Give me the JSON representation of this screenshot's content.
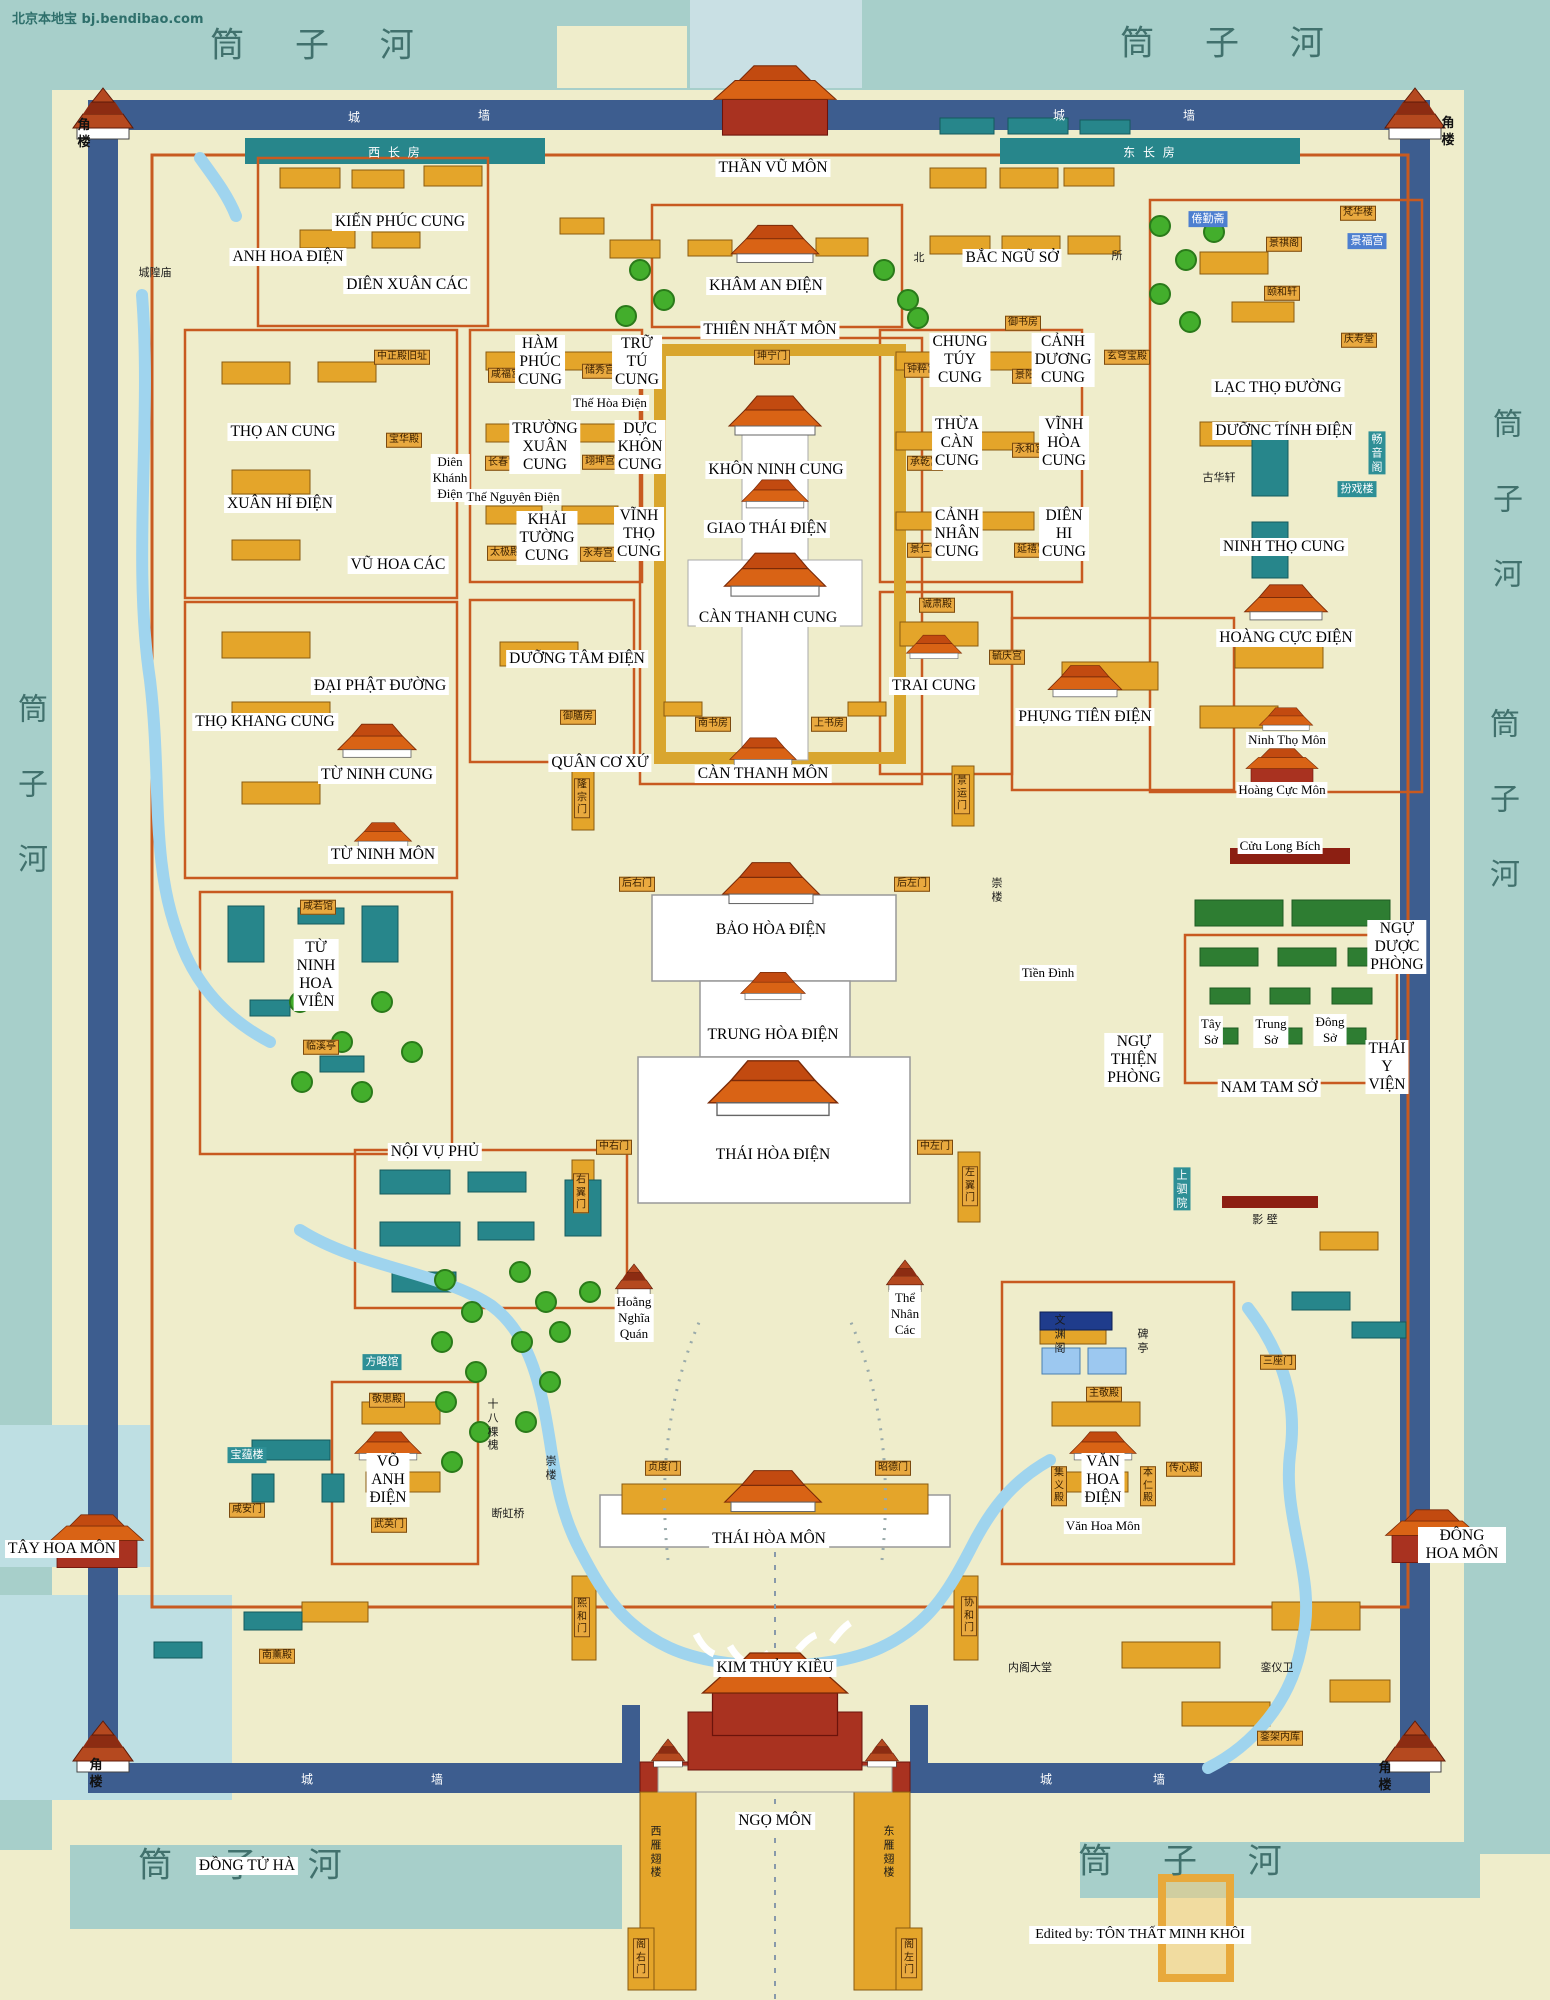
{
  "map": {
    "watermark": "北京本地宝  bj.bendibao.com",
    "credit": "Edited by: TÔN THẤT MINH KHÔI"
  },
  "colors": {
    "moat": "#A7CFCA",
    "ground": "#EFEDCB",
    "wall": "#3D5D8F",
    "building_orange": "#E4A52A",
    "building_teal": "#27868B",
    "garden_green": "#2E7D32",
    "water": "#9FD4EE",
    "roof_orange": "#D96315",
    "roof_red": "#A93220",
    "courtyard_outline": "#C85A20",
    "river_text": "#41716D",
    "label_blue": "#4D7FD0",
    "label_teal": "#2E8F96",
    "plate": "#E9A93F"
  },
  "labels": [
    {
      "t": "筒 子 河",
      "x": 322,
      "y": 42,
      "c": "rv"
    },
    {
      "t": "筒 子 河",
      "x": 1232,
      "y": 40,
      "c": "rv"
    },
    {
      "t": "筒 子 河",
      "x": 1190,
      "y": 1858,
      "c": "rv"
    },
    {
      "t": "筒 子 河",
      "x": 250,
      "y": 1862,
      "c": "rv"
    },
    {
      "t": "筒\n子\n河",
      "x": 33,
      "y": 785,
      "c": "rvv"
    },
    {
      "t": "筒\n子\n河",
      "x": 1508,
      "y": 500,
      "c": "rvv"
    },
    {
      "t": "筒\n子\n河",
      "x": 1505,
      "y": 800,
      "c": "rvv"
    },
    {
      "t": "角\n楼",
      "x": 84,
      "y": 135,
      "c": "ck"
    },
    {
      "t": "角\n楼",
      "x": 1448,
      "y": 133,
      "c": "ck"
    },
    {
      "t": "角\n楼",
      "x": 96,
      "y": 1775,
      "c": "ck"
    },
    {
      "t": "角\n楼",
      "x": 1385,
      "y": 1778,
      "c": "ck"
    },
    {
      "t": "城",
      "x": 355,
      "y": 117,
      "c": "wl"
    },
    {
      "t": "墙",
      "x": 485,
      "y": 115,
      "c": "wl"
    },
    {
      "t": "城",
      "x": 1060,
      "y": 115,
      "c": "wl"
    },
    {
      "t": "墙",
      "x": 1190,
      "y": 115,
      "c": "wl"
    },
    {
      "t": "城",
      "x": 308,
      "y": 1779,
      "c": "wl"
    },
    {
      "t": "墙",
      "x": 438,
      "y": 1779,
      "c": "wl"
    },
    {
      "t": "城",
      "x": 1047,
      "y": 1779,
      "c": "wl"
    },
    {
      "t": "墙",
      "x": 1160,
      "y": 1779,
      "c": "wl"
    },
    {
      "t": "西 长 房",
      "x": 395,
      "y": 152,
      "c": "wl"
    },
    {
      "t": "东 长 房",
      "x": 1150,
      "y": 152,
      "c": "wl"
    },
    {
      "t": "THẦN VŨ MÔN",
      "x": 773,
      "y": 168,
      "c": "vn"
    },
    {
      "t": "KIẾN PHÚC CUNG",
      "x": 400,
      "y": 222,
      "c": "vn"
    },
    {
      "t": "ANH HOA ĐIỆN",
      "x": 288,
      "y": 257,
      "c": "vn"
    },
    {
      "t": "DIÊN XUÂN CÁC",
      "x": 407,
      "y": 285,
      "c": "vn"
    },
    {
      "t": "KHÂM AN ĐIỆN",
      "x": 766,
      "y": 286,
      "c": "vn"
    },
    {
      "t": "BẮC NGŨ SỞ",
      "x": 1012,
      "y": 258,
      "c": "vn"
    },
    {
      "t": "THIÊN NHẤT MÔN",
      "x": 770,
      "y": 330,
      "c": "vn"
    },
    {
      "t": "TRỮ\nTÚ\nCUNG",
      "x": 637,
      "y": 362,
      "c": "vn"
    },
    {
      "t": "HÀM\nPHÚC\nCUNG",
      "x": 540,
      "y": 362,
      "c": "vn"
    },
    {
      "t": "CHUNG\nTÚY\nCUNG",
      "x": 960,
      "y": 360,
      "c": "vn"
    },
    {
      "t": "CẢNH\nDƯƠNG\nCUNG",
      "x": 1063,
      "y": 360,
      "c": "vn"
    },
    {
      "t": "THỌ AN CUNG",
      "x": 283,
      "y": 432,
      "c": "vn"
    },
    {
      "t": "XUÂN HỈ ĐIỆN",
      "x": 280,
      "y": 504,
      "c": "vn"
    },
    {
      "t": "TRƯỜNG\nXUÂN\nCUNG",
      "x": 545,
      "y": 447,
      "c": "vn"
    },
    {
      "t": "DỰC\nKHÔN\nCUNG",
      "x": 640,
      "y": 447,
      "c": "vn"
    },
    {
      "t": "KHÔN NINH CUNG",
      "x": 776,
      "y": 470,
      "c": "vn"
    },
    {
      "t": "THỪA\nCÀN\nCUNG",
      "x": 957,
      "y": 443,
      "c": "vn"
    },
    {
      "t": "VĨNH\nHÒA\nCUNG",
      "x": 1064,
      "y": 443,
      "c": "vn"
    },
    {
      "t": "LẠC THỌ ĐƯỜNG",
      "x": 1278,
      "y": 388,
      "c": "vn"
    },
    {
      "t": "DƯỠNC TÍNH ĐIỆN",
      "x": 1284,
      "y": 431,
      "c": "vn"
    },
    {
      "t": "KHẢI\nTƯỜNG\nCUNG",
      "x": 547,
      "y": 538,
      "c": "vn"
    },
    {
      "t": "VĨNH\nTHỌ\nCUNG",
      "x": 639,
      "y": 534,
      "c": "vn"
    },
    {
      "t": "GIAO THÁI ĐIỆN",
      "x": 767,
      "y": 529,
      "c": "vn"
    },
    {
      "t": "CẢNH\nNHÂN\nCUNG",
      "x": 957,
      "y": 534,
      "c": "vn"
    },
    {
      "t": "DIÊN\nHI\nCUNG",
      "x": 1064,
      "y": 534,
      "c": "vn"
    },
    {
      "t": "NINH THỌ CUNG",
      "x": 1284,
      "y": 547,
      "c": "vn"
    },
    {
      "t": "VŨ HOA CÁC",
      "x": 398,
      "y": 565,
      "c": "vn"
    },
    {
      "t": "CÀN THANH CUNG",
      "x": 768,
      "y": 618,
      "c": "vn"
    },
    {
      "t": "DƯỠNG TÂM ĐIỆN",
      "x": 577,
      "y": 659,
      "c": "vn"
    },
    {
      "t": "TRAI CUNG",
      "x": 934,
      "y": 686,
      "c": "vn"
    },
    {
      "t": "HOÀNG CỰC ĐIỆN",
      "x": 1286,
      "y": 638,
      "c": "vn"
    },
    {
      "t": "PHỤNG TIÊN ĐIỆN",
      "x": 1085,
      "y": 717,
      "c": "vn"
    },
    {
      "t": "ĐẠI PHẬT ĐƯỜNG",
      "x": 380,
      "y": 686,
      "c": "vn"
    },
    {
      "t": "THỌ KHANG CUNG",
      "x": 265,
      "y": 722,
      "c": "vn"
    },
    {
      "t": "QUÂN CƠ XỨ",
      "x": 600,
      "y": 763,
      "c": "vn"
    },
    {
      "t": "CÀN THANH MÔN",
      "x": 763,
      "y": 774,
      "c": "vn"
    },
    {
      "t": "TỪ NINH CUNG",
      "x": 377,
      "y": 775,
      "c": "vn"
    },
    {
      "t": "TỪ NINH MÔN",
      "x": 383,
      "y": 855,
      "c": "vn"
    },
    {
      "t": "BẢO HÒA ĐIỆN",
      "x": 771,
      "y": 930,
      "c": "vn"
    },
    {
      "t": "TỪ\nNINH\nHOA\nVIÊN",
      "x": 316,
      "y": 975,
      "c": "vn"
    },
    {
      "t": "NGỰ\nDƯỢC\nPHÒNG",
      "x": 1397,
      "y": 947,
      "c": "vn"
    },
    {
      "t": "TRUNG HÒA ĐIỆN",
      "x": 773,
      "y": 1035,
      "c": "vn"
    },
    {
      "t": "NGỰ\nTHIỆN\nPHÒNG",
      "x": 1134,
      "y": 1060,
      "c": "vn"
    },
    {
      "t": "THÁI\nY\nVIỆN",
      "x": 1387,
      "y": 1067,
      "c": "vn"
    },
    {
      "t": "NAM TAM SỞ",
      "x": 1269,
      "y": 1088,
      "c": "vn"
    },
    {
      "t": "NỘI VỤ PHỦ",
      "x": 435,
      "y": 1152,
      "c": "vn"
    },
    {
      "t": "THÁI HÒA ĐIỆN",
      "x": 773,
      "y": 1155,
      "c": "vn"
    },
    {
      "t": "VÕ\nANH\nĐIỆN",
      "x": 388,
      "y": 1480,
      "c": "vn"
    },
    {
      "t": "VĂN\nHOA\nĐIỆN",
      "x": 1103,
      "y": 1480,
      "c": "vn"
    },
    {
      "t": "THÁI HÒA MÔN",
      "x": 769,
      "y": 1539,
      "c": "vn"
    },
    {
      "t": "TÂY HOA MÔN",
      "x": 62,
      "y": 1549,
      "c": "vn"
    },
    {
      "t": "ĐÔNG HOA MÔN",
      "x": 1462,
      "y": 1545,
      "c": "vn"
    },
    {
      "t": "KIM THỦY KIỀU",
      "x": 775,
      "y": 1668,
      "c": "vn"
    },
    {
      "t": "NGỌ MÔN",
      "x": 775,
      "y": 1821,
      "c": "vn"
    },
    {
      "t": "ĐỒNG TỬ HÀ",
      "x": 247,
      "y": 1866,
      "c": "vn"
    },
    {
      "t": "Ninh Thọ Môn",
      "x": 1287,
      "y": 740,
      "c": "vs"
    },
    {
      "t": "Hoàng Cực Môn",
      "x": 1282,
      "y": 790,
      "c": "vs"
    },
    {
      "t": "Cửu Long Bích",
      "x": 1280,
      "y": 846,
      "c": "vs"
    },
    {
      "t": "Tiền Đình",
      "x": 1048,
      "y": 973,
      "c": "vs"
    },
    {
      "t": "Tây\nSở",
      "x": 1211,
      "y": 1032,
      "c": "vs"
    },
    {
      "t": "Trung\nSở",
      "x": 1271,
      "y": 1032,
      "c": "vs"
    },
    {
      "t": "Đông\nSở",
      "x": 1330,
      "y": 1030,
      "c": "vs"
    },
    {
      "t": "Hoằng\nNghĩa\nQuán",
      "x": 634,
      "y": 1318,
      "c": "vs"
    },
    {
      "t": "Thể\nNhân\nCác",
      "x": 905,
      "y": 1314,
      "c": "vs"
    },
    {
      "t": "Văn Hoa Môn",
      "x": 1103,
      "y": 1526,
      "c": "vs"
    },
    {
      "t": "Diên\nKhánh\nĐiện",
      "x": 450,
      "y": 478,
      "c": "vs"
    },
    {
      "t": "Thế Nguyên Điện",
      "x": 513,
      "y": 497,
      "c": "vs"
    },
    {
      "t": "Thế Hòa Điện",
      "x": 610,
      "y": 403,
      "c": "vs"
    },
    {
      "t": "中正殿旧址",
      "x": 402,
      "y": 357,
      "c": "cp"
    },
    {
      "t": "宝华殿",
      "x": 404,
      "y": 440,
      "c": "cp"
    },
    {
      "t": "坤宁门",
      "x": 772,
      "y": 357,
      "c": "cp"
    },
    {
      "t": "咸福宫",
      "x": 506,
      "y": 375,
      "c": "cp"
    },
    {
      "t": "储秀宫",
      "x": 600,
      "y": 371,
      "c": "cp"
    },
    {
      "t": "长春宫",
      "x": 503,
      "y": 463,
      "c": "cp"
    },
    {
      "t": "翊坤宫",
      "x": 600,
      "y": 462,
      "c": "cp"
    },
    {
      "t": "太极殿",
      "x": 505,
      "y": 553,
      "c": "cp"
    },
    {
      "t": "永寿宫",
      "x": 598,
      "y": 554,
      "c": "cp"
    },
    {
      "t": "钟粹宫",
      "x": 922,
      "y": 370,
      "c": "cp"
    },
    {
      "t": "景阳宫",
      "x": 1030,
      "y": 376,
      "c": "cp"
    },
    {
      "t": "承乾宫",
      "x": 925,
      "y": 463,
      "c": "cp"
    },
    {
      "t": "永和宫",
      "x": 1030,
      "y": 450,
      "c": "cp"
    },
    {
      "t": "景仁宫",
      "x": 925,
      "y": 550,
      "c": "cp"
    },
    {
      "t": "延禧宫",
      "x": 1032,
      "y": 550,
      "c": "cp"
    },
    {
      "t": "御书房",
      "x": 1023,
      "y": 323,
      "c": "cp"
    },
    {
      "t": "玄穹宝殿",
      "x": 1127,
      "y": 357,
      "c": "cp"
    },
    {
      "t": "景祺阁",
      "x": 1284,
      "y": 244,
      "c": "cp"
    },
    {
      "t": "颐和轩",
      "x": 1282,
      "y": 293,
      "c": "cp"
    },
    {
      "t": "梵华楼",
      "x": 1358,
      "y": 213,
      "c": "cp"
    },
    {
      "t": "庆寿堂",
      "x": 1359,
      "y": 340,
      "c": "cp"
    },
    {
      "t": "诚肃殿",
      "x": 937,
      "y": 605,
      "c": "cp"
    },
    {
      "t": "毓庆宫",
      "x": 1007,
      "y": 657,
      "c": "cp"
    },
    {
      "t": "南书房",
      "x": 713,
      "y": 724,
      "c": "cp"
    },
    {
      "t": "上书房",
      "x": 829,
      "y": 724,
      "c": "cp"
    },
    {
      "t": "御膳房",
      "x": 578,
      "y": 717,
      "c": "cp"
    },
    {
      "t": "隆\n宗\n门",
      "x": 582,
      "y": 798,
      "c": "cp"
    },
    {
      "t": "景\n运\n门",
      "x": 962,
      "y": 794,
      "c": "cp"
    },
    {
      "t": "后右门",
      "x": 637,
      "y": 884,
      "c": "cp"
    },
    {
      "t": "后左门",
      "x": 912,
      "y": 884,
      "c": "cp"
    },
    {
      "t": "中右门",
      "x": 614,
      "y": 1147,
      "c": "cp"
    },
    {
      "t": "中左门",
      "x": 935,
      "y": 1147,
      "c": "cp"
    },
    {
      "t": "右\n翼\n门",
      "x": 581,
      "y": 1193,
      "c": "cp"
    },
    {
      "t": "左\n翼\n门",
      "x": 970,
      "y": 1186,
      "c": "cp"
    },
    {
      "t": "贞度门",
      "x": 663,
      "y": 1468,
      "c": "cp"
    },
    {
      "t": "昭德门",
      "x": 893,
      "y": 1468,
      "c": "cp"
    },
    {
      "t": "武英门",
      "x": 389,
      "y": 1525,
      "c": "cp"
    },
    {
      "t": "咸安门",
      "x": 247,
      "y": 1510,
      "c": "cp"
    },
    {
      "t": "敬思殿",
      "x": 387,
      "y": 1400,
      "c": "cp"
    },
    {
      "t": "主敬殿",
      "x": 1104,
      "y": 1394,
      "c": "cp"
    },
    {
      "t": "三座门",
      "x": 1278,
      "y": 1362,
      "c": "cp"
    },
    {
      "t": "熙\n和\n门",
      "x": 582,
      "y": 1617,
      "c": "cp"
    },
    {
      "t": "协\n和\n门",
      "x": 969,
      "y": 1616,
      "c": "cp"
    },
    {
      "t": "阁\n右\n门",
      "x": 641,
      "y": 1958,
      "c": "cp"
    },
    {
      "t": "阁\n左\n门",
      "x": 909,
      "y": 1958,
      "c": "cp"
    },
    {
      "t": "咸若馆",
      "x": 318,
      "y": 907,
      "c": "cp"
    },
    {
      "t": "临溪亭",
      "x": 321,
      "y": 1047,
      "c": "cp"
    },
    {
      "t": "南薰殿",
      "x": 277,
      "y": 1656,
      "c": "cp"
    },
    {
      "t": "銮架内库",
      "x": 1280,
      "y": 1738,
      "c": "cp"
    },
    {
      "t": "传心殿",
      "x": 1184,
      "y": 1469,
      "c": "cp"
    },
    {
      "t": "本\n仁\n殿",
      "x": 1148,
      "y": 1486,
      "c": "cp"
    },
    {
      "t": "集\n义\n殿",
      "x": 1059,
      "y": 1486,
      "c": "cp"
    },
    {
      "t": "城隍庙",
      "x": 155,
      "y": 273,
      "c": "cs"
    },
    {
      "t": "北",
      "x": 919,
      "y": 258,
      "c": "cs"
    },
    {
      "t": "所",
      "x": 1117,
      "y": 256,
      "c": "cs"
    },
    {
      "t": "古华轩",
      "x": 1219,
      "y": 478,
      "c": "cs"
    },
    {
      "t": "断虹桥",
      "x": 508,
      "y": 1514,
      "c": "cs"
    },
    {
      "t": "十\n八\n棵\n槐",
      "x": 493,
      "y": 1425,
      "c": "cs"
    },
    {
      "t": "崇\n楼",
      "x": 997,
      "y": 890,
      "c": "cs"
    },
    {
      "t": "崇\n楼",
      "x": 551,
      "y": 1468,
      "c": "cs"
    },
    {
      "t": "内阁大堂",
      "x": 1030,
      "y": 1668,
      "c": "cs"
    },
    {
      "t": "銮仪卫",
      "x": 1277,
      "y": 1668,
      "c": "cs"
    },
    {
      "t": "影 壁",
      "x": 1265,
      "y": 1220,
      "c": "cs"
    },
    {
      "t": "文\n渊\n阁",
      "x": 1060,
      "y": 1334,
      "c": "cs"
    },
    {
      "t": "碑\n亭",
      "x": 1143,
      "y": 1341,
      "c": "cs"
    },
    {
      "t": "西\n雁\n翅\n楼",
      "x": 656,
      "y": 1852,
      "c": "cs"
    },
    {
      "t": "东\n雁\n翅\n楼",
      "x": 889,
      "y": 1852,
      "c": "cs"
    },
    {
      "t": "倦勤斋",
      "x": 1208,
      "y": 219,
      "c": "cb"
    },
    {
      "t": "景福宫",
      "x": 1367,
      "y": 241,
      "c": "cb"
    },
    {
      "t": "方略馆",
      "x": 382,
      "y": 1362,
      "c": "ct"
    },
    {
      "t": "宝蕴楼",
      "x": 247,
      "y": 1455,
      "c": "ct"
    },
    {
      "t": "上\n驷\n院",
      "x": 1182,
      "y": 1189,
      "c": "ct"
    },
    {
      "t": "畅\n音\n阁",
      "x": 1377,
      "y": 453,
      "c": "ct"
    },
    {
      "t": "扮戏楼",
      "x": 1357,
      "y": 489,
      "c": "ct"
    }
  ]
}
